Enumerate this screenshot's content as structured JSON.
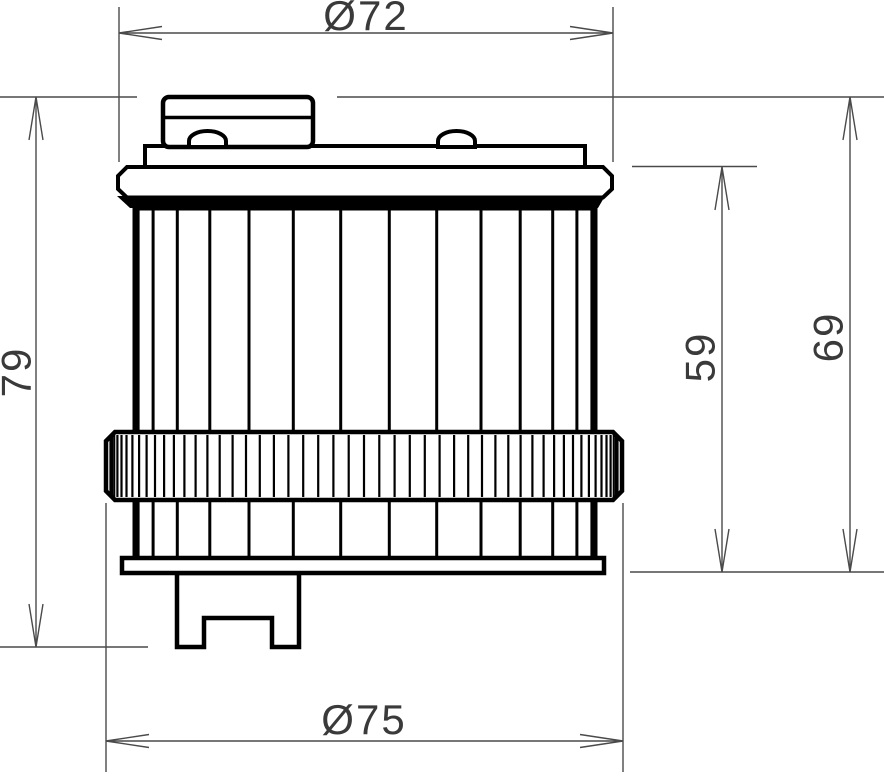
{
  "drawing": {
    "type": "technical dimension drawing",
    "colors": {
      "background": "#ffffff",
      "outline": "#000000",
      "fill": "#ffffff",
      "dimension_line": "#4a4a4a",
      "dimension_text": "#3a3a3a"
    },
    "dimensions": {
      "dia_top": {
        "label": "Ø72",
        "value": 72,
        "kind": "diameter"
      },
      "dia_bottom": {
        "label": "Ø75",
        "value": 75,
        "kind": "diameter"
      },
      "height_left": {
        "label": "79",
        "value": 79,
        "kind": "height"
      },
      "height_inner": {
        "label": "59",
        "value": 59,
        "kind": "height"
      },
      "height_outer": {
        "label": "69",
        "value": 69,
        "kind": "height"
      }
    }
  }
}
